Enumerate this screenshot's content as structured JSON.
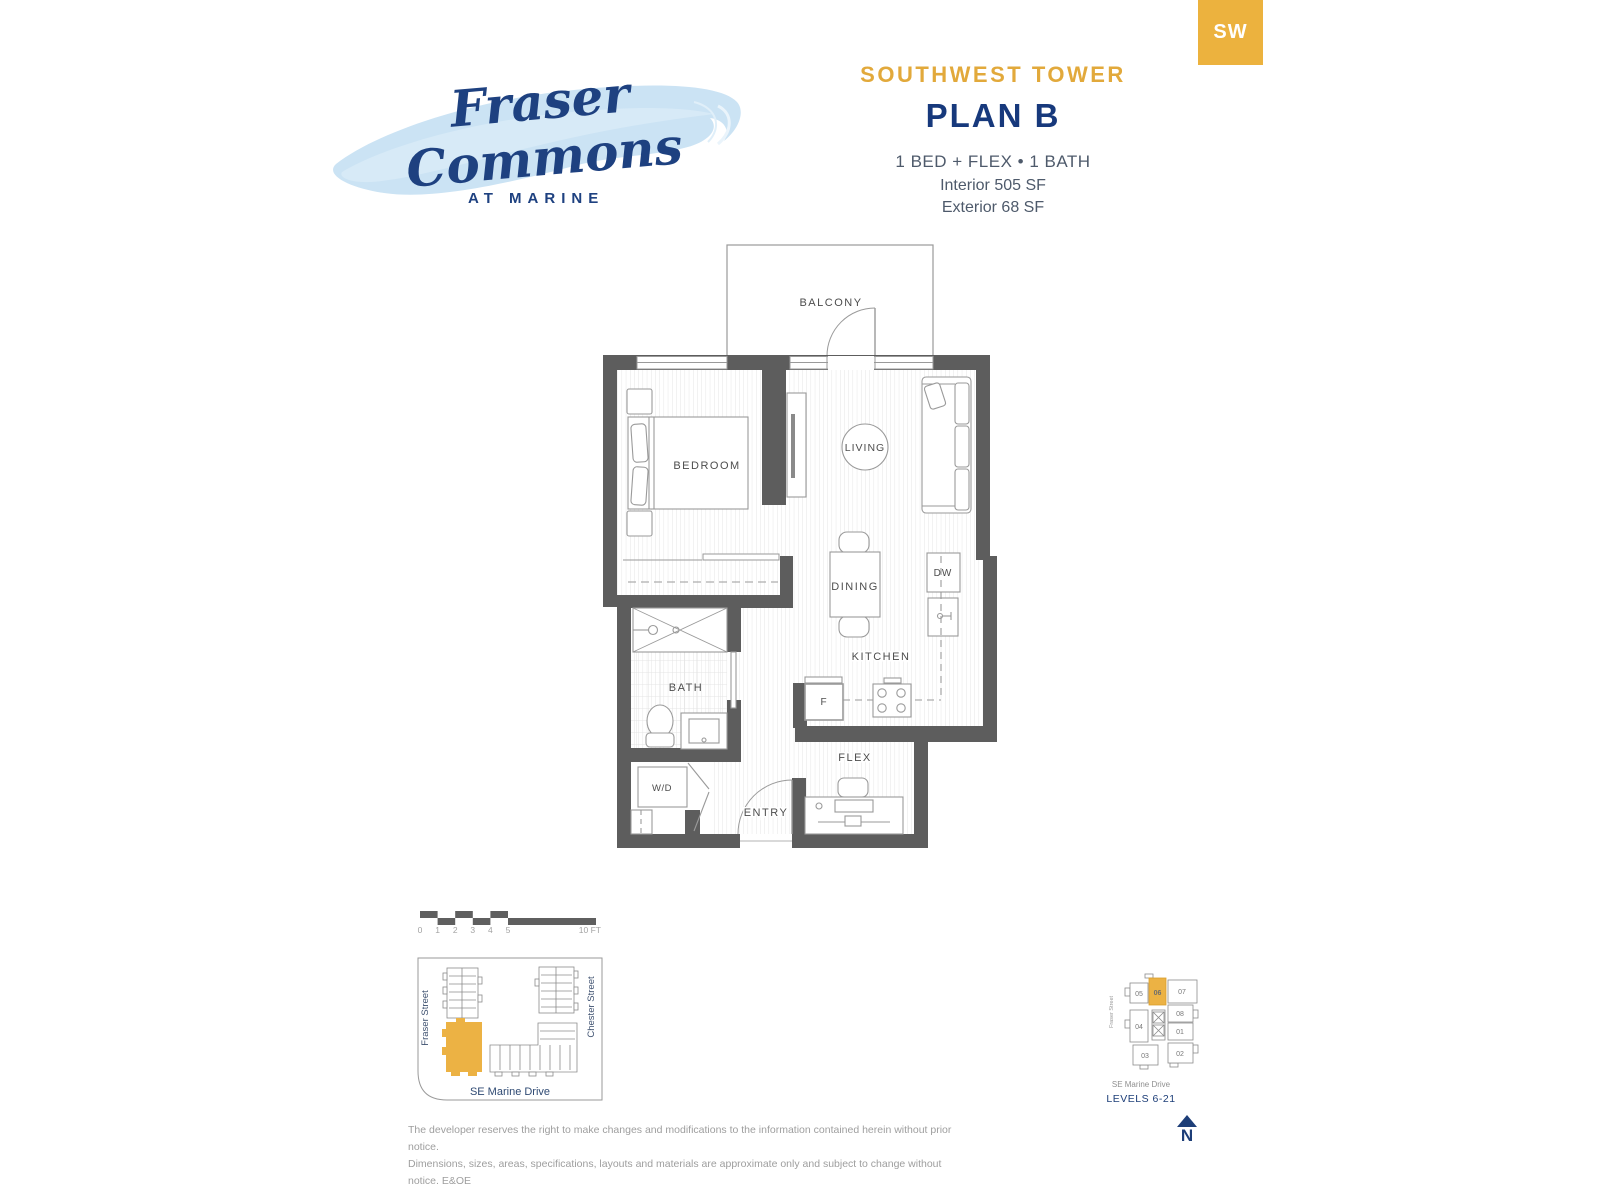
{
  "badge": {
    "label": "SW"
  },
  "logo": {
    "name_line1": "Fraser",
    "name_line2": "Commons",
    "tagline": "AT MARINE"
  },
  "header": {
    "tower": "SOUTHWEST TOWER",
    "plan": "PLAN B",
    "config": "1 BED + FLEX • 1 BATH",
    "interior": "Interior 505 SF",
    "exterior": "Exterior 68 SF"
  },
  "floorplan": {
    "labels": {
      "balcony": "BALCONY",
      "bedroom": "BEDROOM",
      "living": "LIVING",
      "dining": "DINING",
      "kitchen": "KITCHEN",
      "bath": "BATH",
      "flex": "FLEX",
      "entry": "ENTRY",
      "washer_dryer": "W/D",
      "dishwasher": "DW",
      "fridge": "F"
    }
  },
  "scale_bar": {
    "ticks": [
      "0",
      "1",
      "2",
      "3",
      "4",
      "5"
    ],
    "end": "10 FT"
  },
  "site_map": {
    "street_left": "Fraser Street",
    "street_right": "Chester Street",
    "street_bottom": "SE Marine Drive"
  },
  "key_plan": {
    "units": [
      "05",
      "06",
      "07",
      "08",
      "01",
      "04",
      "03",
      "02"
    ],
    "highlighted_unit": "06",
    "street_left": "Fraser Street",
    "street_bottom": "SE Marine Drive",
    "levels": "LEVELS 6-21",
    "north_label": "N"
  },
  "disclaimer": {
    "line1": "The developer reserves the right to make changes and modifications to the information contained herein without prior notice.",
    "line2": "Dimensions, sizes, areas, specifications, layouts and materials are approximate only and subject to change without notice. E&OE"
  },
  "colors": {
    "gold": "#ecb23e",
    "navy": "#17397c",
    "slate": "#4e5a6b",
    "wall": "#5d5d5d"
  }
}
